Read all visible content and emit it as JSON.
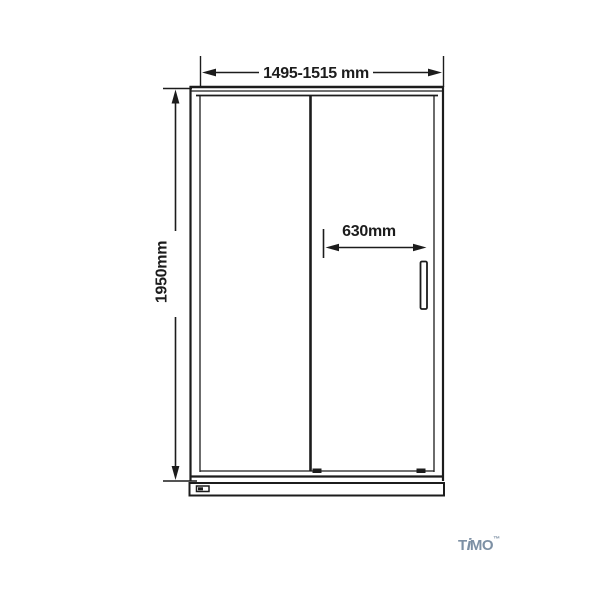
{
  "page": {
    "background_color": "#ffffff",
    "width_px": 600,
    "height_px": 600
  },
  "diagram": {
    "kind": "technical-drawing",
    "subject": "sliding shower door front elevation",
    "line_color": "#1c1c1c",
    "labels": {
      "overall_width": "1495-1515 mm",
      "overall_height": "1950mm",
      "door_opening": "630mm"
    },
    "dimensions_mm": {
      "overall_width_min": 1495,
      "overall_width_max": 1515,
      "overall_height": 1950,
      "door_opening": 630
    }
  },
  "logo": {
    "brand": "TIMO",
    "part_t": "T",
    "part_i": "i",
    "part_mo": "MO",
    "trademark": "™",
    "color": "#7d90a4"
  }
}
